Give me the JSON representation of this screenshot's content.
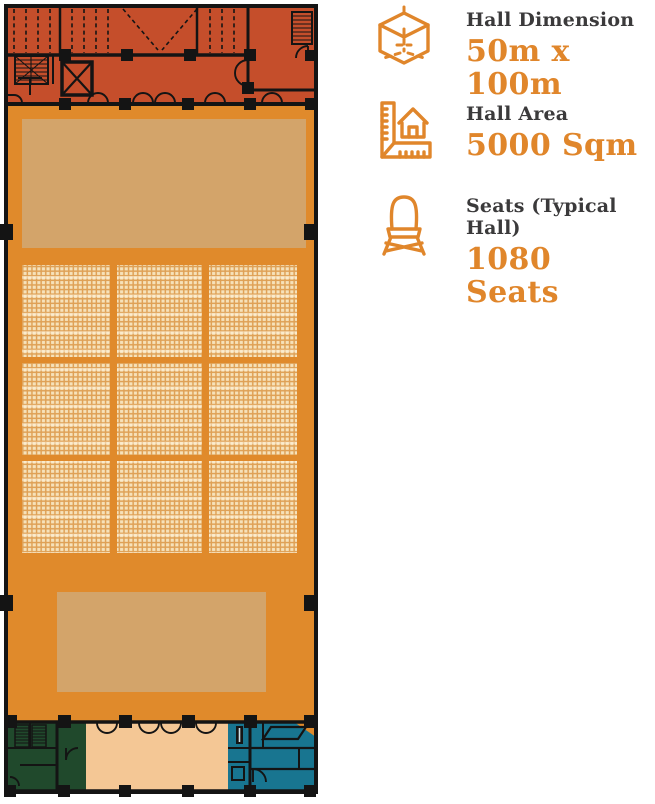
{
  "page": {
    "background": "#ffffff"
  },
  "info_panel": {
    "rows": [
      {
        "icon": "cube-icon",
        "label": "Hall Dimension",
        "value": "50m x 100m"
      },
      {
        "icon": "ruler-house-icon",
        "label": "Hall Area",
        "value": "5000 Sqm"
      },
      {
        "icon": "chair-icon",
        "label": "Seats (Typical Hall)",
        "value": "1080 Seats"
      }
    ],
    "colors": {
      "label": "#3b3a3b",
      "value": "#e0862b",
      "icon_stroke": "#e0862b"
    }
  },
  "floor_plan": {
    "type": "exhibition-hall-floor-plan",
    "wall_color": "#141414",
    "zones": [
      {
        "name": "backstage-strip",
        "color": "#c54e2b"
      },
      {
        "name": "main-hall",
        "color": "#e08a2b"
      },
      {
        "name": "stage-platform",
        "color": "#d3a46a"
      },
      {
        "name": "rear-platform",
        "color": "#d3a46a"
      },
      {
        "name": "seating-area",
        "blocks": 9,
        "layout": "3x3",
        "color_base": "#dfa156",
        "color_seat": "#f6e2ba"
      },
      {
        "name": "service-block-green",
        "color": "#20492c"
      },
      {
        "name": "lobby",
        "color": "#f4c795"
      },
      {
        "name": "service-block-blue",
        "color": "#187590"
      }
    ]
  }
}
